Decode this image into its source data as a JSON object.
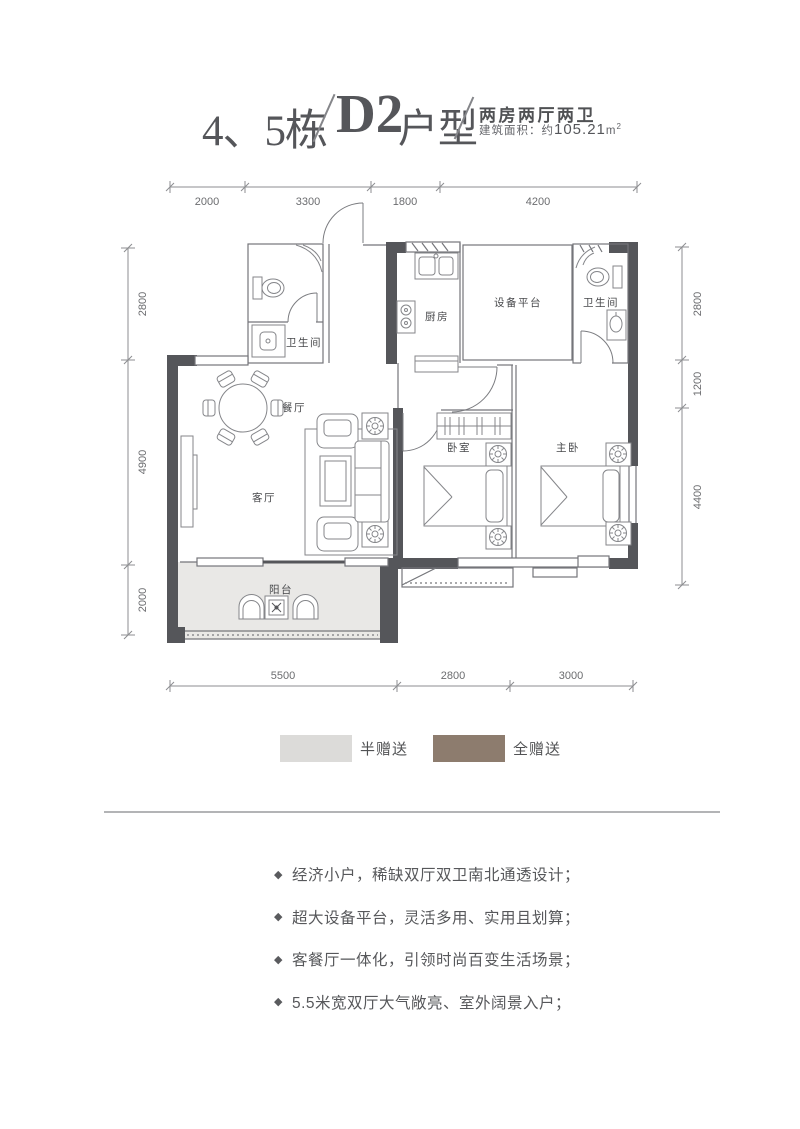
{
  "header": {
    "block": "4、5栋",
    "unit_bold": "D2",
    "unit_suffix": "户型",
    "layout": "两房两厅两卫",
    "area_prefix": "建筑面积：约",
    "area_value": "105.21",
    "area_unit_base": "m",
    "area_unit_sup": "2"
  },
  "plan": {
    "rooms": {
      "bath_left": "卫生间",
      "kitchen": "厨房",
      "platform": "设备平台",
      "bath_right": "卫生间",
      "dining": "餐厅",
      "living": "客厅",
      "bedroom": "卧室",
      "master": "主卧",
      "balcony": "阳台"
    },
    "dims": {
      "top": [
        "2000",
        "3300",
        "1800",
        "4200"
      ],
      "left": [
        "2800",
        "4900",
        "2000"
      ],
      "right": [
        "2800",
        "1200",
        "4400"
      ],
      "bottom": [
        "5500",
        "2800",
        "3000"
      ]
    },
    "colors": {
      "wall": "#55565a",
      "platform_fill": "#a4948a",
      "balcony_fill": "#e9e8e6"
    }
  },
  "legend": {
    "items": [
      {
        "label": "半赠送",
        "color": "#dcdbd9"
      },
      {
        "label": "全赠送",
        "color": "#8d7c6e"
      }
    ]
  },
  "features": {
    "bullet": "◆",
    "items": [
      "经济小户，稀缺双厅双卫南北通透设计；",
      "超大设备平台，灵活多用、实用且划算；",
      "客餐厅一体化，引领时尚百变生活场景；",
      "5.5米宽双厅大气敞亮、室外阔景入户；"
    ]
  }
}
